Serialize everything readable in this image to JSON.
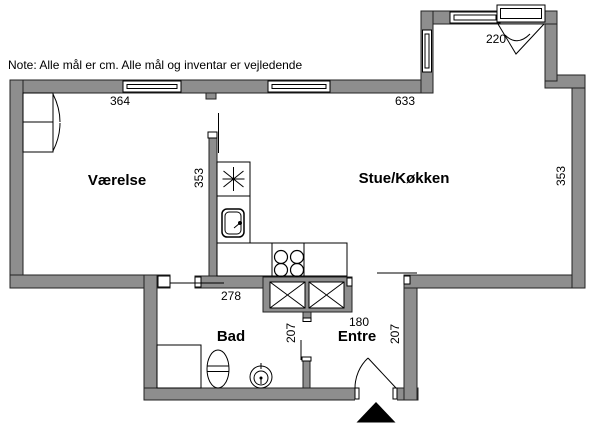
{
  "note": "Note: Alle mål er cm. Alle mål og inventar er vejledende",
  "rooms": {
    "bedroom": "Værelse",
    "living_kitchen": "Stue/Køkken",
    "bathroom": "Bad",
    "entrance": "Entre"
  },
  "dimensions": {
    "bedroom_width": "364",
    "living_width": "633",
    "balcony_door_width": "220",
    "bedroom_depth": "353",
    "living_depth": "353",
    "bathroom_width": "278",
    "bathroom_depth": "207",
    "entrance_width": "180",
    "entrance_depth": "207"
  },
  "colors": {
    "wall_fill": "#8e8e8e",
    "wall_outline": "#222222",
    "fixture_outline": "#000000",
    "background": "#ffffff",
    "entrance_arrow": "#000000"
  }
}
